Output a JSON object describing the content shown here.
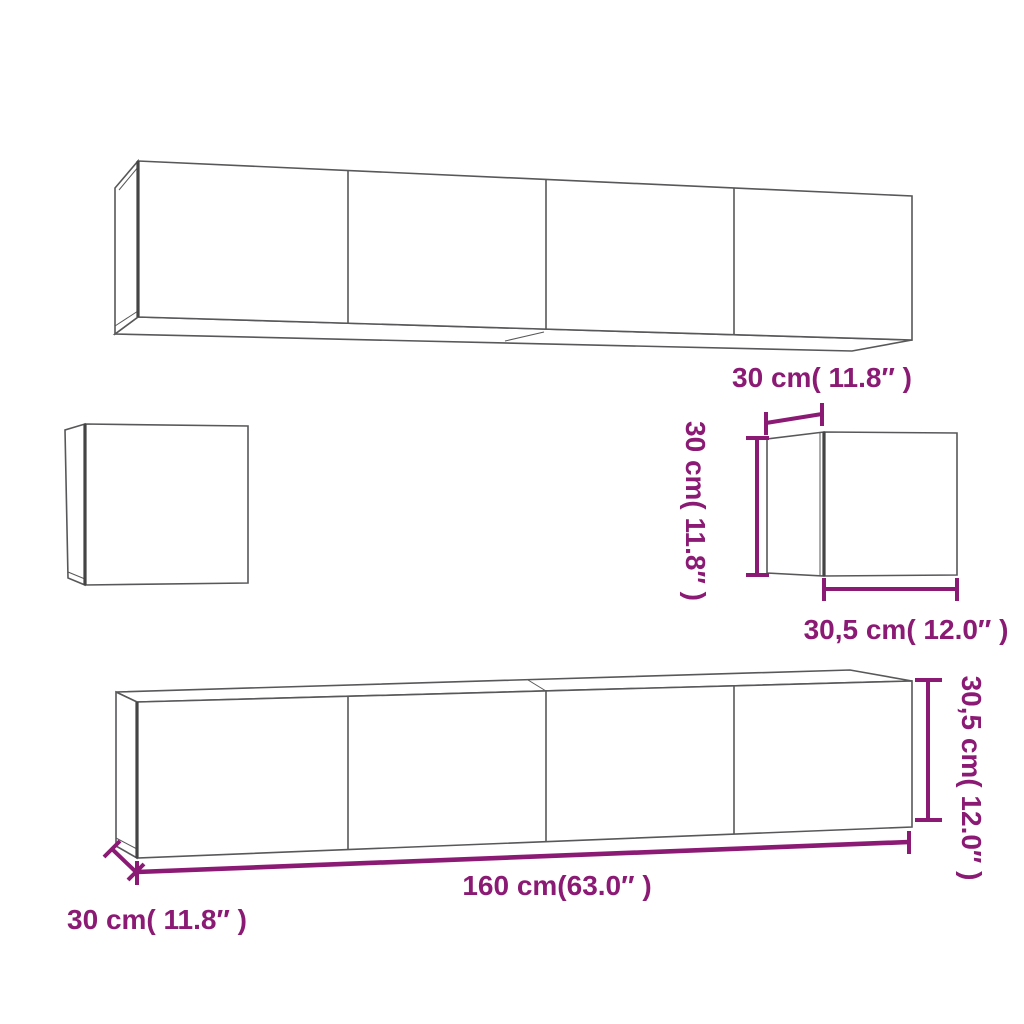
{
  "diagram": {
    "kind": "furniture-dimension-diagram",
    "pieces": {
      "long_wall_cabinet_top": {
        "doors_visible": 4
      },
      "small_wall_cabinet_left": {
        "doors_visible": 1
      },
      "small_wall_cabinet_right": {
        "width_label": "30 cm( 11.8″  )",
        "height_label": "30 cm( 11.8″  )",
        "depth_label": "30,5 cm( 12.0″  )"
      },
      "long_tv_cabinet_bottom": {
        "doors_visible": 4,
        "width_label": "160 cm(63.0″  )",
        "height_label": "30,5 cm( 12.0″  )",
        "depth_label": "30 cm( 11.8″  )"
      }
    }
  },
  "colors": {
    "dimension_accent": "#8B1A74",
    "outline_gray": "#58585a",
    "background": "#ffffff"
  }
}
